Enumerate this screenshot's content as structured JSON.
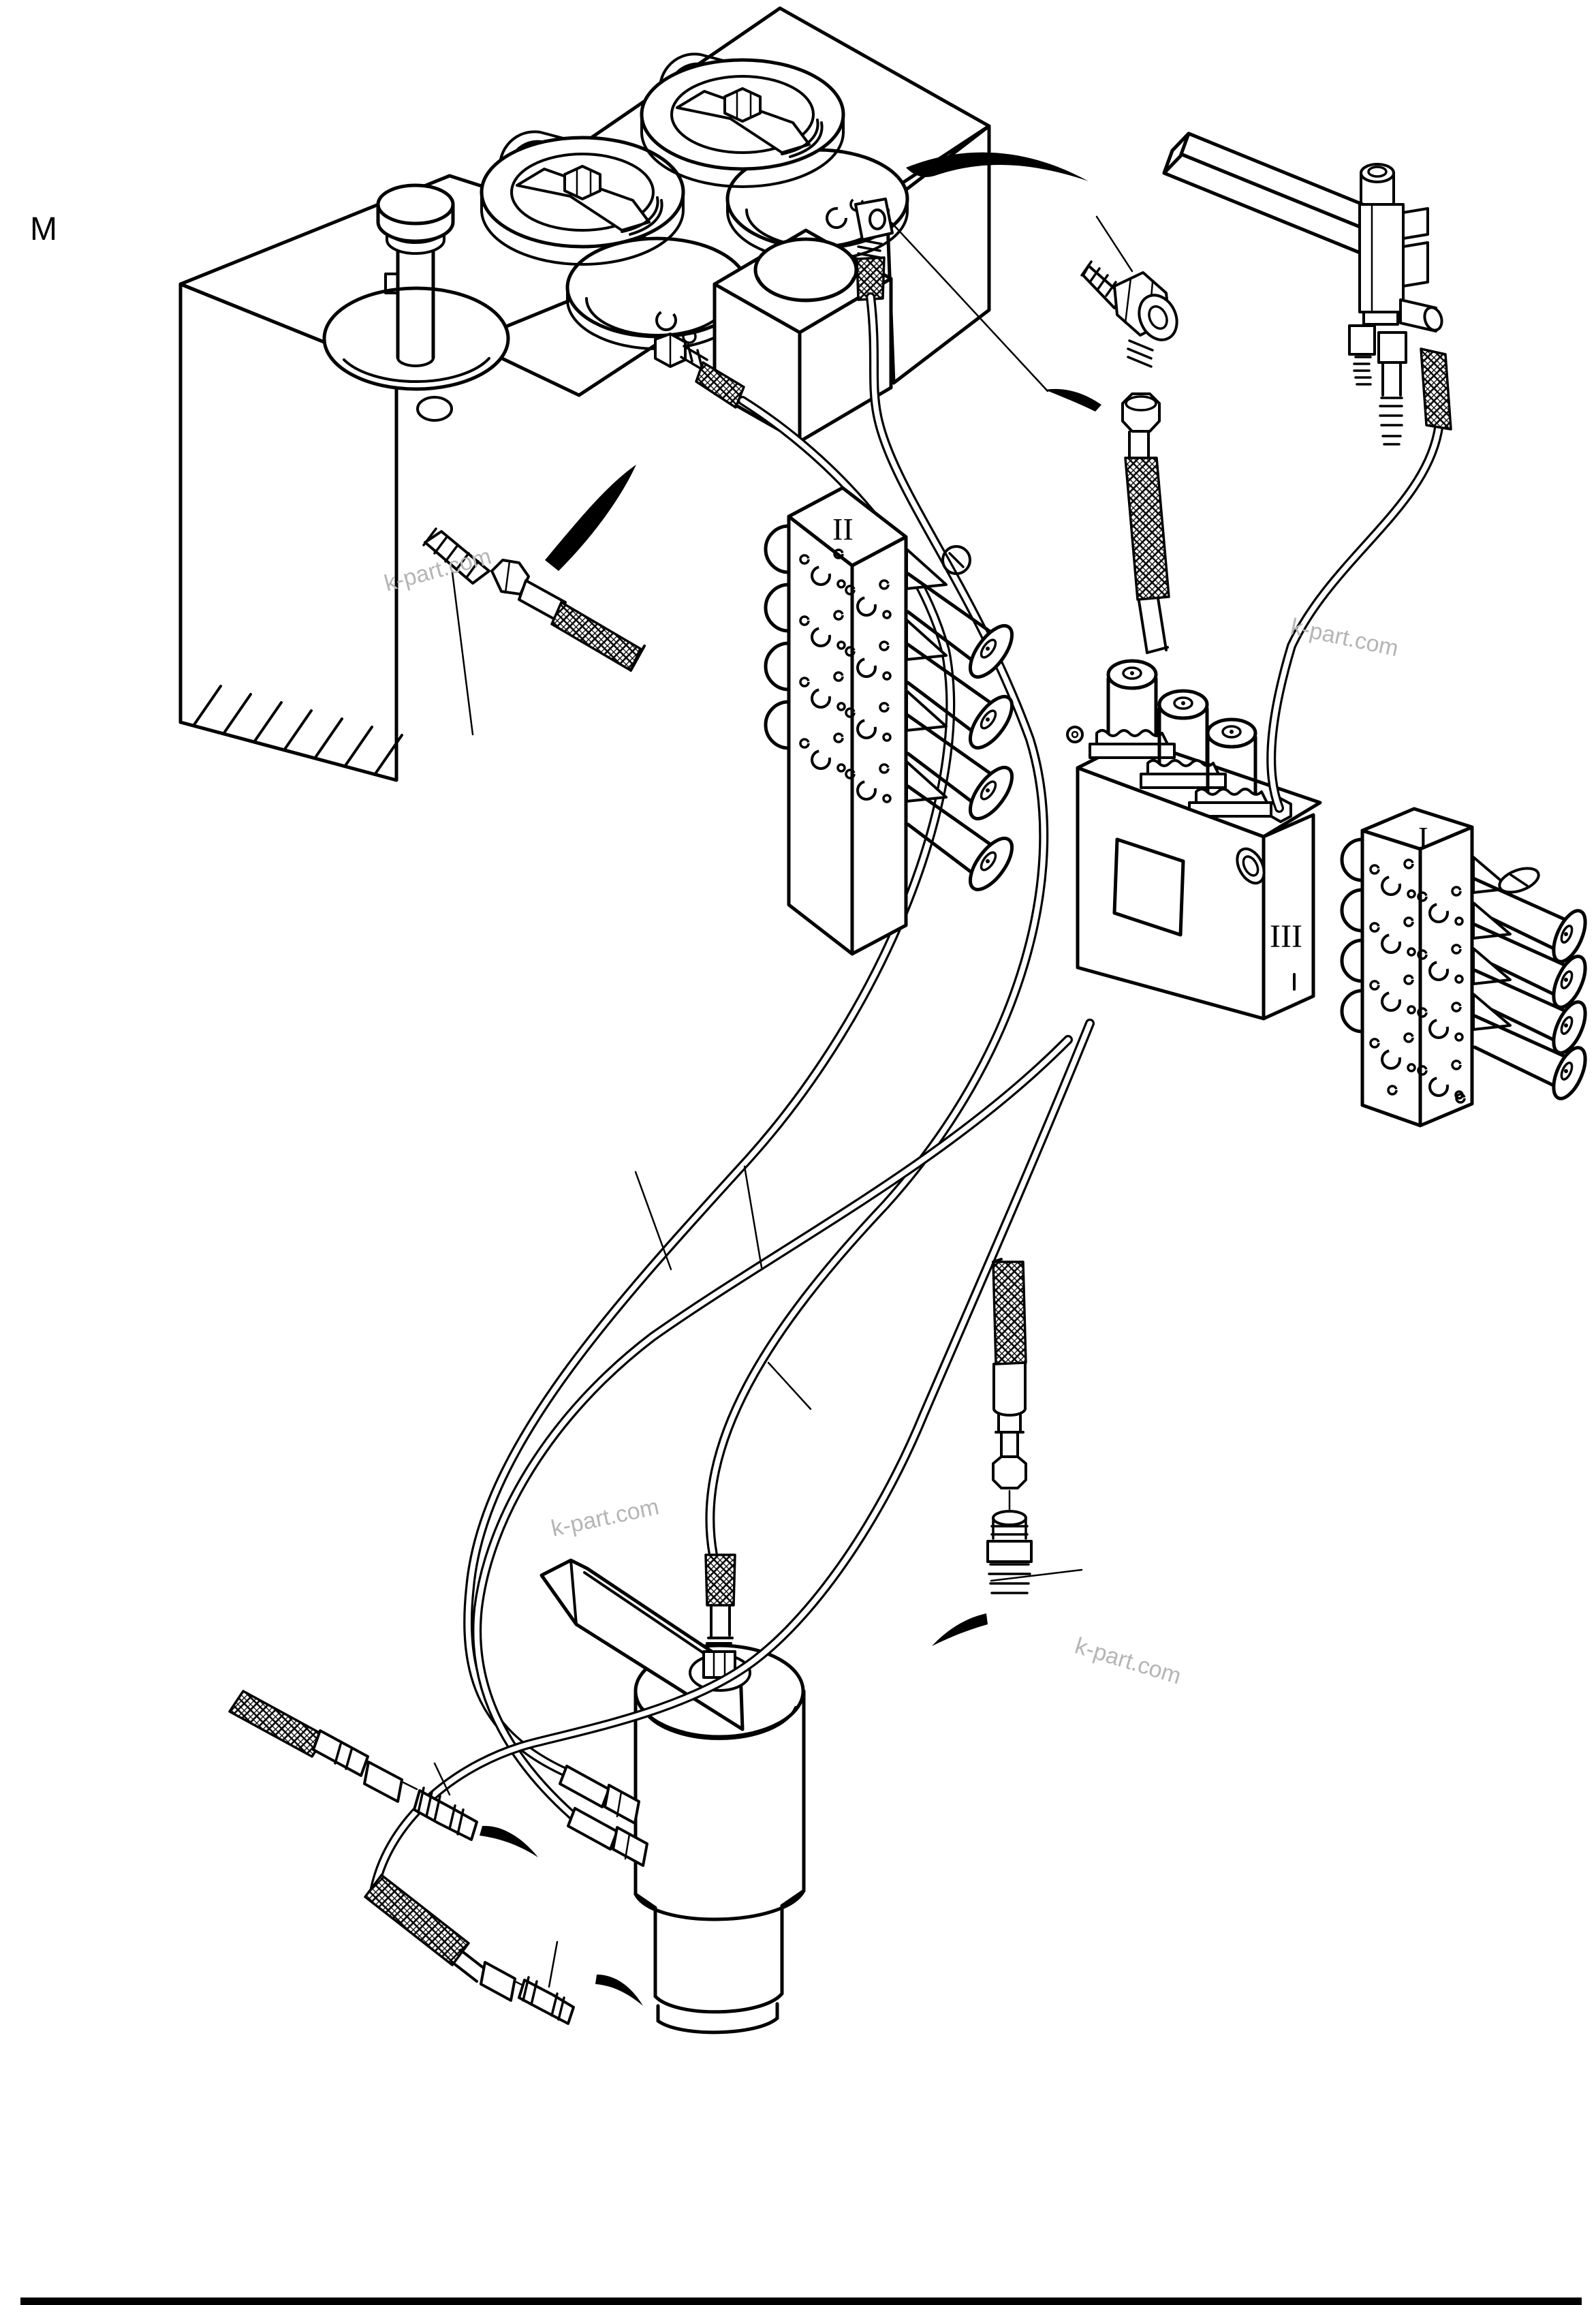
{
  "page": {
    "background": "#ffffff",
    "ink": "#000000",
    "watermark_color": "#b5b5b5"
  },
  "diagram": {
    "section_label": "M",
    "labels": {
      "valve_block_upper": "II",
      "manifold": "III",
      "valve_block_right": "I"
    },
    "watermarks": [
      {
        "text": "k-part.com"
      },
      {
        "text": "k-part.com"
      },
      {
        "text": "k-part.com"
      },
      {
        "text": "k-part.com"
      }
    ],
    "components": [
      "hydraulic-tank",
      "breather-cap",
      "filler-cap",
      "filler-cap",
      "tank-opening-ring",
      "tank-opening-ring",
      "pump-mount-block",
      "banjo-fitting",
      "hose-assembly",
      "control-valve-block-II",
      "solenoid-manifold-III",
      "control-valve-block-I",
      "relief-valve-assembly",
      "pressure-sender-fitting",
      "hydraulic-filter",
      "filter-bracket",
      "hose-end-fitting",
      "threaded-adapter",
      "callout-arrow"
    ]
  }
}
